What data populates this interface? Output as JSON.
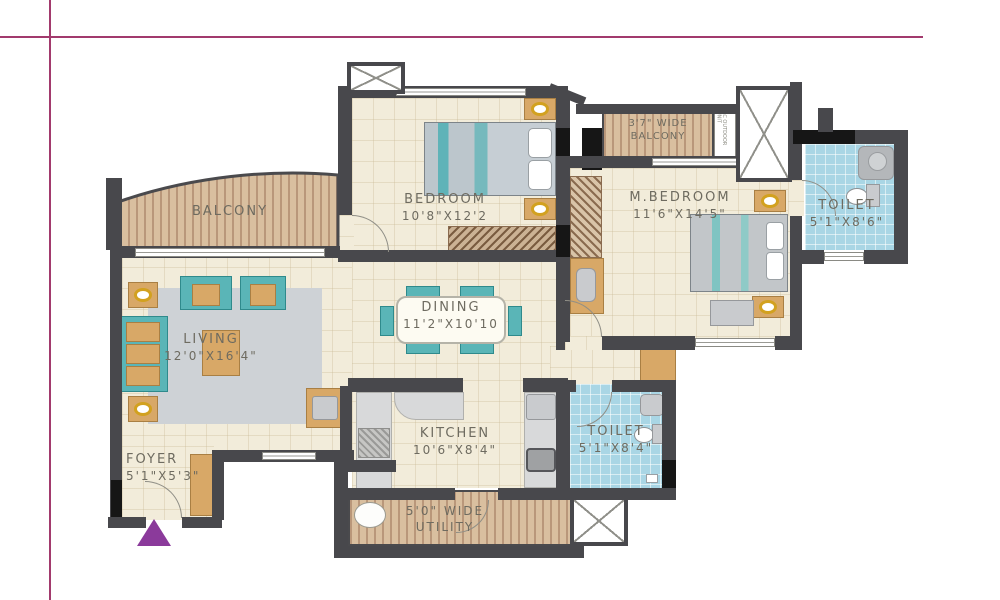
{
  "rooms": {
    "balcony": {
      "label": "BALCONY"
    },
    "bedroom": {
      "label": "BEDROOM",
      "dims": "10'8\"X12'2"
    },
    "master_bedroom": {
      "label": "M.BEDROOM",
      "dims": "11'6\"X14'5\""
    },
    "master_toilet": {
      "label": "TOILET",
      "dims": "5'1\"X8'6\""
    },
    "master_balcony": {
      "line1": "3'7\" WIDE",
      "line2": "BALCONY"
    },
    "living": {
      "label": "LIVING",
      "dims": "12'0\"X16'4\""
    },
    "dining": {
      "label": "DINING",
      "dims": "11'2\"X10'10"
    },
    "kitchen": {
      "label": "KITCHEN",
      "dims": "10'6\"X8'4\""
    },
    "common_toilet": {
      "label": "TOILET",
      "dims": "5'1\"X8'4\""
    },
    "foyer": {
      "label": "FOYER",
      "dims": "5'1\"X5'3\""
    },
    "utility": {
      "line1": "5'0\" WIDE",
      "line2": "UTILITY"
    }
  },
  "annotations": {
    "ac_unit_vertical": "AC OUTDOOR UNIT",
    "utility_note": "AC OUTDOOR"
  },
  "colors": {
    "wall": "#48484c",
    "floor": "#f2ecda",
    "toilet_tile": "#a9d6e5",
    "deck": "#d9bf9f",
    "accent_line": "#a23a6d",
    "entry_marker": "#8b3a9b",
    "furniture_teal": "#5ab5b7",
    "furniture_tan": "#d8a867"
  }
}
